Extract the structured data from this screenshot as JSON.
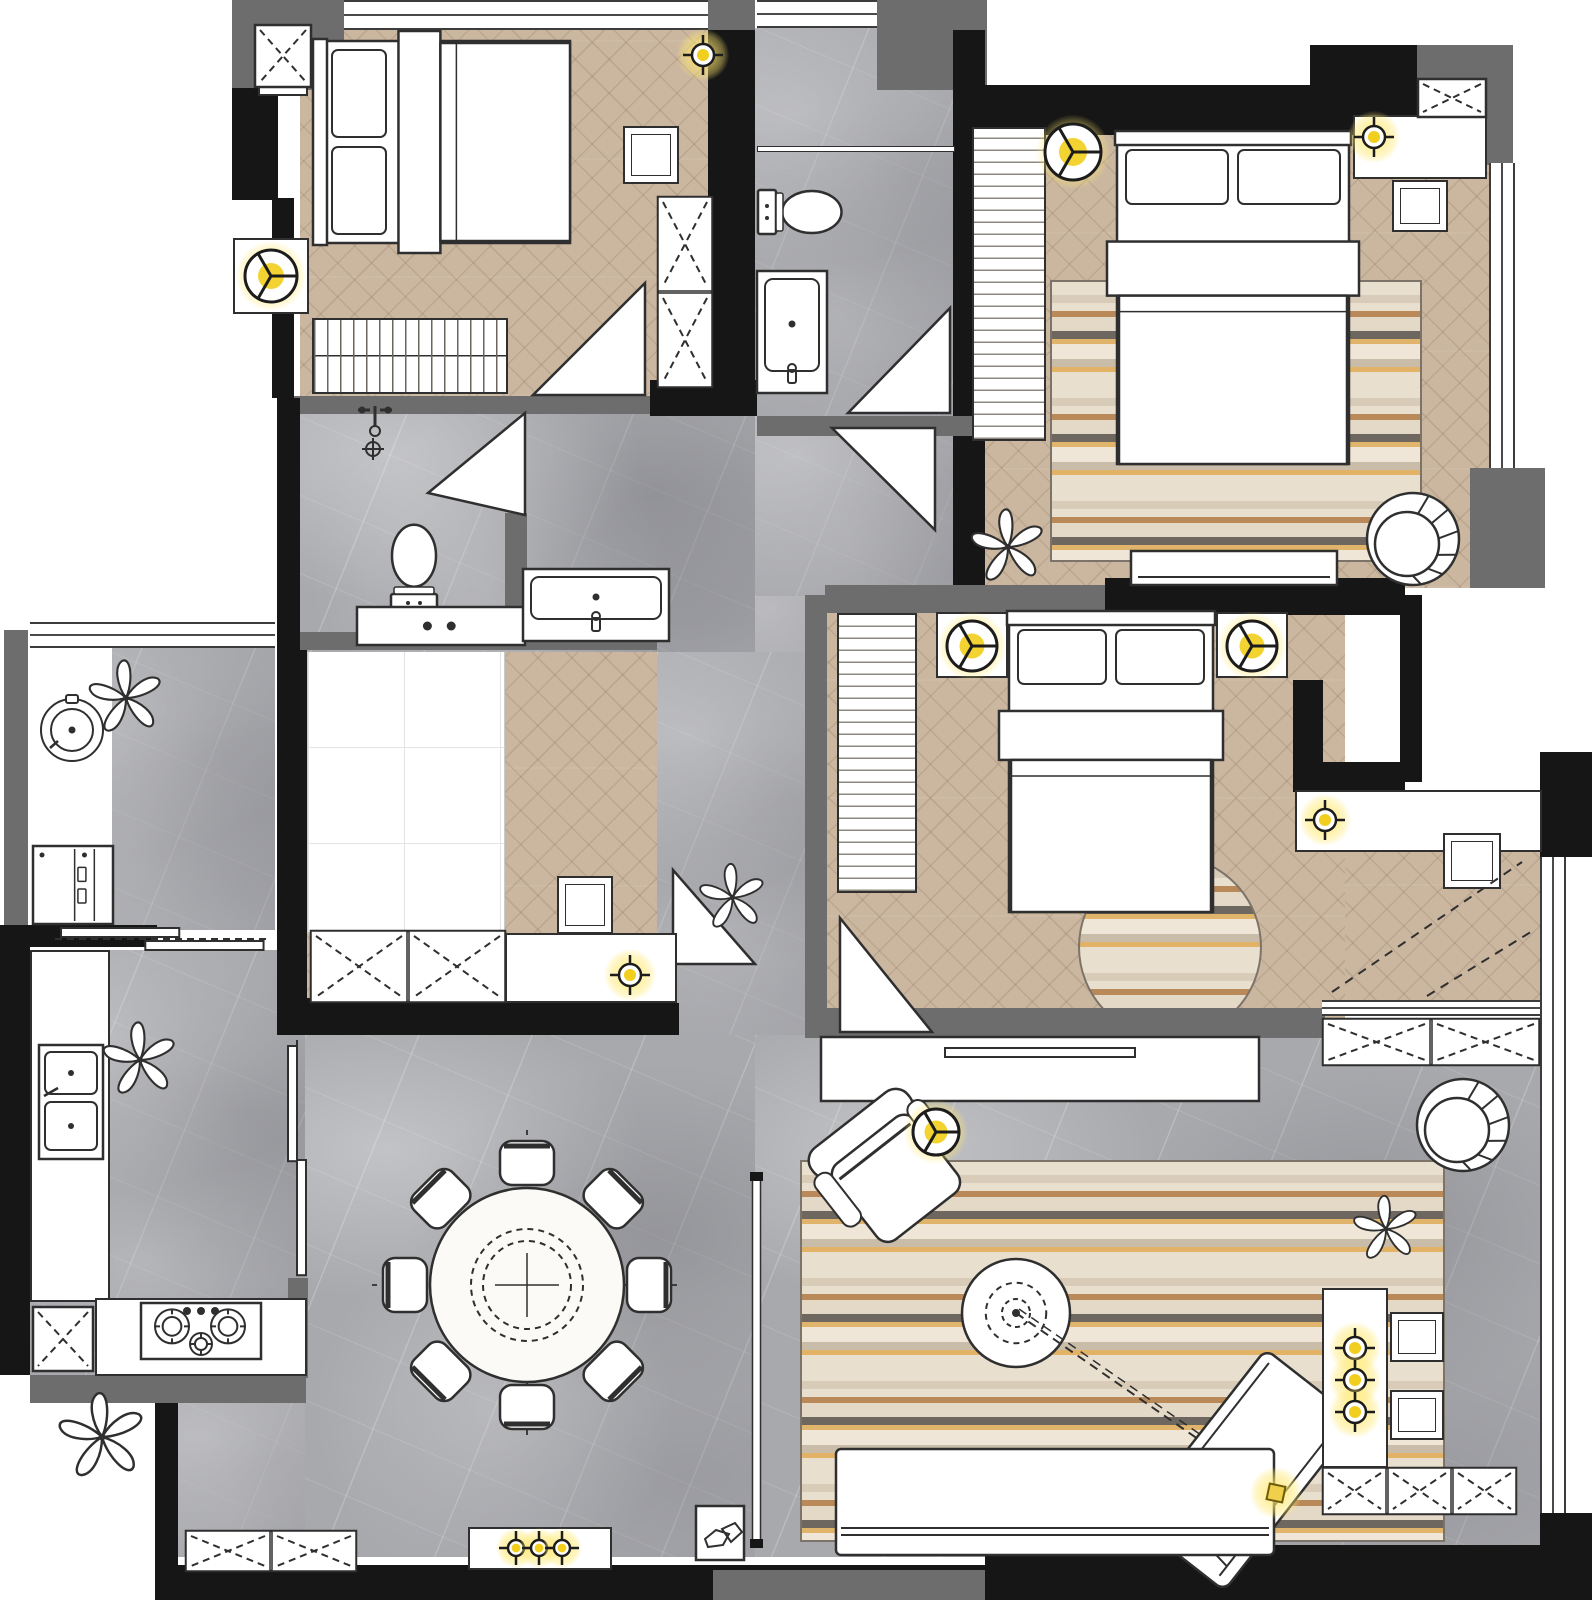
{
  "canvas": {
    "w": 1592,
    "h": 1600
  },
  "palette": {
    "wall_black": "#161616",
    "wall_gray": "#6d6d6d",
    "wood_floor": "#cbb7a0",
    "marble_floor": "#a8a9ad",
    "furniture_line": "#2f2f2f",
    "accent_yellow": "#f2cf1f",
    "rug_beige": "#e9dfce",
    "rug_brown": "#b9895a",
    "rug_dark": "#6e675f",
    "rug_orange": "#e0b46a"
  },
  "floors": [
    {
      "n": "bedroom-a-floor",
      "m": "wood",
      "x": 300,
      "y": 28,
      "w": 410,
      "h": 368
    },
    {
      "n": "bathroom-floor",
      "m": "marble",
      "x": 755,
      "y": 28,
      "w": 200,
      "h": 390
    },
    {
      "n": "master-bedroom-floor",
      "m": "wood",
      "x": 985,
      "y": 110,
      "w": 505,
      "h": 478
    },
    {
      "n": "bedroom-c-floor",
      "m": "wood",
      "x": 827,
      "y": 595,
      "w": 518,
      "h": 440
    },
    {
      "n": "bedroom-c-ext-floor",
      "m": "wood",
      "x": 1345,
      "y": 848,
      "w": 198,
      "h": 156
    },
    {
      "n": "tatami-room-floor",
      "m": "wood",
      "x": 307,
      "y": 650,
      "w": 350,
      "h": 355
    },
    {
      "n": "tatami-platform",
      "m": "platform",
      "x": 307,
      "y": 650,
      "w": 198,
      "h": 283
    },
    {
      "n": "hall-floor",
      "m": "marble",
      "x": 300,
      "y": 396,
      "w": 455,
      "h": 256
    },
    {
      "n": "hall-east-floor",
      "m": "marble",
      "x": 755,
      "y": 416,
      "w": 230,
      "h": 180
    },
    {
      "n": "hall-corner-floor",
      "m": "marble",
      "x": 755,
      "y": 596,
      "w": 72,
      "h": 58
    },
    {
      "n": "corridor-floor",
      "m": "marble",
      "x": 657,
      "y": 652,
      "w": 170,
      "h": 383
    },
    {
      "n": "balcony-floor",
      "m": "marble",
      "x": 28,
      "y": 648,
      "w": 247,
      "h": 282
    },
    {
      "n": "balcony-white-strip",
      "m": "white",
      "x": 28,
      "y": 648,
      "w": 84,
      "h": 282
    },
    {
      "n": "kitchen-floor",
      "m": "marble",
      "x": 30,
      "y": 950,
      "w": 276,
      "h": 428
    },
    {
      "n": "dining-floor",
      "m": "marble",
      "x": 305,
      "y": 1035,
      "w": 450,
      "h": 522
    },
    {
      "n": "dining-floor-sw",
      "m": "marble",
      "x": 178,
      "y": 1403,
      "w": 127,
      "h": 154
    },
    {
      "n": "living-floor",
      "m": "marble",
      "x": 755,
      "y": 1035,
      "w": 790,
      "h": 522
    }
  ],
  "rugs": [
    {
      "n": "master-bedroom-rug",
      "s": "rect",
      "x": 1050,
      "y": 280,
      "w": 372,
      "h": 282
    },
    {
      "n": "bedroom-c-round-rug",
      "s": "round",
      "x": 1078,
      "y": 855,
      "w": 184,
      "h": 184
    },
    {
      "n": "living-room-rug",
      "s": "rect",
      "x": 800,
      "y": 1160,
      "w": 645,
      "h": 382
    }
  ],
  "walls": [
    {
      "n": "wall-top-left-gray",
      "t": "g",
      "x": 232,
      "y": 0,
      "w": 112,
      "h": 90
    },
    {
      "n": "wall-left-upper",
      "t": "b",
      "x": 232,
      "y": 88,
      "w": 46,
      "h": 112
    },
    {
      "n": "wall-left-lower",
      "t": "b",
      "x": 272,
      "y": 198,
      "w": 22,
      "h": 200
    },
    {
      "n": "wall-bedroom-a-south",
      "t": "g",
      "x": 294,
      "y": 396,
      "w": 362,
      "h": 18
    },
    {
      "n": "wall-bath-sw",
      "t": "b",
      "x": 650,
      "y": 380,
      "w": 107,
      "h": 36
    },
    {
      "n": "wall-bedroom-a-east",
      "t": "b",
      "x": 708,
      "y": 28,
      "w": 47,
      "h": 362
    },
    {
      "n": "wall-bedroom-a-east-cap",
      "t": "g",
      "x": 708,
      "y": 0,
      "w": 47,
      "h": 30
    },
    {
      "n": "wall-bath-ne",
      "t": "g",
      "x": 877,
      "y": 0,
      "w": 110,
      "h": 90
    },
    {
      "n": "wall-bath-east",
      "t": "b",
      "x": 953,
      "y": 30,
      "w": 32,
      "h": 558
    },
    {
      "n": "wall-master-north",
      "t": "b",
      "x": 985,
      "y": 85,
      "w": 432,
      "h": 50
    },
    {
      "n": "wall-master-north-up",
      "t": "b",
      "x": 1310,
      "y": 45,
      "w": 107,
      "h": 42
    },
    {
      "n": "wall-ne-gray-h",
      "t": "g",
      "x": 1417,
      "y": 45,
      "w": 96,
      "h": 38
    },
    {
      "n": "wall-ne-gray-v",
      "t": "g",
      "x": 1487,
      "y": 50,
      "w": 26,
      "h": 115
    },
    {
      "n": "wall-east-gray-mid",
      "t": "g",
      "x": 1470,
      "y": 468,
      "w": 75,
      "h": 120
    },
    {
      "n": "wall-master-south-gray",
      "t": "g",
      "x": 825,
      "y": 585,
      "w": 282,
      "h": 28
    },
    {
      "n": "wall-master-south-black",
      "t": "b",
      "x": 1105,
      "y": 578,
      "w": 300,
      "h": 37
    },
    {
      "n": "wall-shaft-east",
      "t": "b",
      "x": 1400,
      "y": 595,
      "w": 22,
      "h": 187
    },
    {
      "n": "wall-nook-v",
      "t": "b",
      "x": 1293,
      "y": 680,
      "w": 30,
      "h": 112
    },
    {
      "n": "wall-nook-h",
      "t": "b",
      "x": 1293,
      "y": 762,
      "w": 112,
      "h": 28
    },
    {
      "n": "wall-entry-ne",
      "t": "b",
      "x": 1540,
      "y": 752,
      "w": 52,
      "h": 105
    },
    {
      "n": "wall-bedroom-c-west",
      "t": "g",
      "x": 805,
      "y": 595,
      "w": 22,
      "h": 440
    },
    {
      "n": "wall-bedroom-c-south",
      "t": "g",
      "x": 805,
      "y": 1008,
      "w": 520,
      "h": 30
    },
    {
      "n": "wall-hall-west",
      "t": "b",
      "x": 277,
      "y": 398,
      "w": 23,
      "h": 244
    },
    {
      "n": "wall-tatami-west",
      "t": "b",
      "x": 277,
      "y": 640,
      "w": 30,
      "h": 365
    },
    {
      "n": "wall-tatami-south",
      "t": "b",
      "x": 277,
      "y": 1003,
      "w": 402,
      "h": 32
    },
    {
      "n": "wall-powder-east",
      "t": "g",
      "x": 505,
      "y": 513,
      "w": 22,
      "h": 137
    },
    {
      "n": "wall-tatami-north",
      "t": "g",
      "x": 300,
      "y": 632,
      "w": 357,
      "h": 18
    },
    {
      "n": "wall-hall-gray-east",
      "t": "g",
      "x": 757,
      "y": 416,
      "w": 228,
      "h": 20
    },
    {
      "n": "wall-sink-alcove",
      "t": "g",
      "x": 512,
      "y": 566,
      "w": 12,
      "h": 78
    },
    {
      "n": "wall-balcony-west",
      "t": "g",
      "x": 4,
      "y": 630,
      "w": 24,
      "h": 298
    },
    {
      "n": "wall-balcony-kitchen",
      "t": "b",
      "x": 0,
      "y": 925,
      "w": 157,
      "h": 22
    },
    {
      "n": "wall-kitchen-west",
      "t": "b",
      "x": 0,
      "y": 947,
      "w": 30,
      "h": 428
    },
    {
      "n": "wall-kitchen-south-gray",
      "t": "g",
      "x": 30,
      "y": 1375,
      "w": 276,
      "h": 28
    },
    {
      "n": "wall-dining-west",
      "t": "b",
      "x": 155,
      "y": 1403,
      "w": 23,
      "h": 197
    },
    {
      "n": "wall-kitchen-ne",
      "t": "b",
      "x": 280,
      "y": 998,
      "w": 50,
      "h": 37
    },
    {
      "n": "wall-kitchen-east-low",
      "t": "g",
      "x": 288,
      "y": 1278,
      "w": 20,
      "h": 100
    },
    {
      "n": "wall-south-black",
      "t": "b",
      "x": 170,
      "y": 1565,
      "w": 845,
      "h": 35
    },
    {
      "n": "wall-south-gray",
      "t": "g",
      "x": 713,
      "y": 1570,
      "w": 275,
      "h": 30
    },
    {
      "n": "wall-south-east-black",
      "t": "b",
      "x": 985,
      "y": 1545,
      "w": 607,
      "h": 55
    },
    {
      "n": "wall-se-corner",
      "t": "b",
      "x": 1540,
      "y": 1513,
      "w": 52,
      "h": 87
    }
  ],
  "windows": [
    {
      "n": "window-bedroom-a",
      "o": "h",
      "x": 344,
      "y": 0,
      "w": 364,
      "h": 30
    },
    {
      "n": "window-bathroom",
      "o": "h",
      "x": 757,
      "y": 0,
      "w": 120,
      "h": 28
    },
    {
      "n": "window-balcony",
      "o": "h",
      "x": 30,
      "y": 622,
      "w": 245,
      "h": 26
    },
    {
      "n": "window-master-east",
      "o": "v",
      "x": 1489,
      "y": 163,
      "w": 26,
      "h": 305
    },
    {
      "n": "window-living-east",
      "o": "v",
      "x": 1540,
      "y": 857,
      "w": 26,
      "h": 656
    },
    {
      "n": "window-sill-entry",
      "o": "h",
      "x": 1322,
      "y": 1000,
      "w": 218,
      "h": 16
    }
  ],
  "doors": [
    {
      "n": "door-bedroom-a",
      "x": 533,
      "y": 283,
      "w": 112,
      "h": 112,
      "p": "0,112 112,112 112,0"
    },
    {
      "n": "door-powder-room",
      "x": 428,
      "y": 413,
      "w": 97,
      "h": 102,
      "p": "0,80 97,0 97,102"
    },
    {
      "n": "door-bathroom",
      "x": 848,
      "y": 308,
      "w": 102,
      "h": 105,
      "p": "102,0 102,105 0,105"
    },
    {
      "n": "door-master",
      "x": 832,
      "y": 428,
      "w": 103,
      "h": 102,
      "p": "0,0 103,0 103,102"
    },
    {
      "n": "door-bedroom-c",
      "x": 840,
      "y": 918,
      "w": 92,
      "h": 114,
      "p": "0,0 92,114 0,114"
    },
    {
      "n": "door-tatami",
      "x": 673,
      "y": 870,
      "w": 82,
      "h": 94,
      "p": "0,0 0,94 82,94"
    }
  ],
  "sliding_doors": [
    {
      "n": "sliding-door-balcony",
      "o": "h",
      "x": 55,
      "y": 926,
      "w": 215,
      "h": 26
    },
    {
      "n": "sliding-door-kitchen",
      "o": "v",
      "x": 286,
      "y": 1040,
      "w": 22,
      "h": 240
    }
  ],
  "furniture": [
    {
      "n": "bedroom-a-bed",
      "t": "bed-h",
      "x": 312,
      "y": 38,
      "w": 262,
      "h": 208
    },
    {
      "n": "bedroom-a-shelf",
      "t": "box",
      "x": 258,
      "y": 30,
      "w": 50,
      "h": 66
    },
    {
      "n": "bedroom-a-lamp-table",
      "t": "box",
      "x": 233,
      "y": 238,
      "w": 76,
      "h": 76
    },
    {
      "n": "bedroom-a-side-table",
      "t": "boxline",
      "x": 623,
      "y": 126,
      "w": 56,
      "h": 58
    },
    {
      "n": "bedroom-a-wardrobe",
      "t": "wx",
      "x": 657,
      "y": 196,
      "w": 56,
      "h": 192,
      "c": 2,
      "d": "col"
    },
    {
      "n": "bedroom-a-radiator",
      "t": "slatv",
      "x": 312,
      "y": 318,
      "w": 196,
      "h": 76
    },
    {
      "n": "duct-panel",
      "t": "wx",
      "x": 254,
      "y": 24,
      "w": 58,
      "h": 64,
      "c": 1,
      "d": "row"
    },
    {
      "n": "shower-glass",
      "t": "glass",
      "x": 757,
      "y": 146,
      "w": 198,
      "h": 6
    },
    {
      "n": "bathroom-toilet",
      "t": "toilet",
      "x": 756,
      "y": 184,
      "w": 90,
      "h": 56,
      "r": -90
    },
    {
      "n": "bathroom-vanity",
      "t": "vanity",
      "x": 756,
      "y": 270,
      "w": 72,
      "h": 124
    },
    {
      "n": "master-wardrobe",
      "t": "slath",
      "x": 972,
      "y": 127,
      "w": 74,
      "h": 314
    },
    {
      "n": "master-bed",
      "t": "bed-v",
      "x": 1114,
      "y": 130,
      "w": 238,
      "h": 338
    },
    {
      "n": "master-desk",
      "t": "box",
      "x": 1353,
      "y": 115,
      "w": 134,
      "h": 64
    },
    {
      "n": "master-corner-cabinet",
      "t": "wx",
      "x": 1417,
      "y": 78,
      "w": 70,
      "h": 40,
      "c": 1,
      "d": "row"
    },
    {
      "n": "master-stool",
      "t": "boxline",
      "x": 1392,
      "y": 180,
      "w": 56,
      "h": 52
    },
    {
      "n": "master-lowboard",
      "t": "lowboard",
      "x": 1130,
      "y": 550,
      "w": 208,
      "h": 36
    },
    {
      "n": "master-shell-chair",
      "t": "shell",
      "x": 1358,
      "y": 482,
      "w": 104,
      "h": 104
    },
    {
      "n": "master-plant",
      "t": "plant",
      "x": 963,
      "y": 505,
      "w": 90,
      "h": 84
    },
    {
      "n": "bedroom-c-wardrobe",
      "t": "slath",
      "x": 837,
      "y": 613,
      "w": 80,
      "h": 280
    },
    {
      "n": "bedroom-c-nightstand-left",
      "t": "box",
      "x": 936,
      "y": 612,
      "w": 72,
      "h": 66
    },
    {
      "n": "bedroom-c-nightstand-right",
      "t": "box",
      "x": 1216,
      "y": 612,
      "w": 72,
      "h": 66
    },
    {
      "n": "bedroom-c-bed",
      "t": "bed-v",
      "x": 1006,
      "y": 610,
      "w": 210,
      "h": 306
    },
    {
      "n": "bedroom-c-desk",
      "t": "box",
      "x": 1295,
      "y": 790,
      "w": 247,
      "h": 62
    },
    {
      "n": "bedroom-c-stool",
      "t": "boxline",
      "x": 1443,
      "y": 833,
      "w": 58,
      "h": 56
    },
    {
      "n": "tatami-stool",
      "t": "boxline",
      "x": 557,
      "y": 876,
      "w": 56,
      "h": 58
    },
    {
      "n": "tatami-wardrobe",
      "t": "wx",
      "x": 310,
      "y": 930,
      "w": 196,
      "h": 73,
      "c": 2,
      "d": "row"
    },
    {
      "n": "tatami-desk",
      "t": "box",
      "x": 505,
      "y": 933,
      "w": 172,
      "h": 70
    },
    {
      "n": "powder-toilet",
      "t": "toilet",
      "x": 385,
      "y": 520,
      "w": 58,
      "h": 94,
      "r": 180
    },
    {
      "n": "powder-counter",
      "t": "vanity2",
      "x": 356,
      "y": 606,
      "w": 170,
      "h": 40
    },
    {
      "n": "water-point-faucet",
      "t": "faucet",
      "x": 352,
      "y": 398,
      "w": 46,
      "h": 44
    },
    {
      "n": "floor-drain-mark",
      "t": "crossmark",
      "x": 360,
      "y": 436,
      "w": 26,
      "h": 26
    },
    {
      "n": "hall-wash-vanity",
      "t": "vanity",
      "x": 522,
      "y": 568,
      "w": 148,
      "h": 74
    },
    {
      "n": "hall-plant",
      "t": "plant",
      "x": 695,
      "y": 860,
      "w": 75,
      "h": 75
    },
    {
      "n": "balcony-washer",
      "t": "washer",
      "x": 36,
      "y": 694,
      "w": 72,
      "h": 72
    },
    {
      "n": "balcony-plant",
      "t": "plant",
      "x": 82,
      "y": 656,
      "w": 88,
      "h": 84
    },
    {
      "n": "balcony-cabinet",
      "t": "cab",
      "x": 32,
      "y": 845,
      "w": 82,
      "h": 80
    },
    {
      "n": "kitchen-counter-west",
      "t": "box",
      "x": 30,
      "y": 950,
      "w": 80,
      "h": 352
    },
    {
      "n": "kitchen-counter-south",
      "t": "box",
      "x": 95,
      "y": 1298,
      "w": 212,
      "h": 78
    },
    {
      "n": "kitchen-sink",
      "t": "ksink",
      "x": 38,
      "y": 1044,
      "w": 66,
      "h": 116
    },
    {
      "n": "kitchen-plant",
      "t": "plant",
      "x": 98,
      "y": 1018,
      "w": 84,
      "h": 84
    },
    {
      "n": "kitchen-cooktop",
      "t": "cooktop",
      "x": 140,
      "y": 1302,
      "w": 122,
      "h": 58
    },
    {
      "n": "kitchen-fridge",
      "t": "wx",
      "x": 32,
      "y": 1306,
      "w": 62,
      "h": 66,
      "c": 1,
      "d": "row"
    },
    {
      "n": "dining-table-set",
      "t": "dset",
      "x": 347,
      "y": 1105,
      "w": 360,
      "h": 360
    },
    {
      "n": "dining-sideboard",
      "t": "box",
      "x": 468,
      "y": 1527,
      "w": 144,
      "h": 43
    },
    {
      "n": "dining-shoe-cabinets",
      "t": "wx",
      "x": 185,
      "y": 1530,
      "w": 172,
      "h": 42,
      "c": 2,
      "d": "row"
    },
    {
      "n": "slipper-box",
      "t": "squig",
      "x": 695,
      "y": 1505,
      "w": 50,
      "h": 56
    },
    {
      "n": "column-divider",
      "t": "divider",
      "x": 750,
      "y": 1172,
      "w": 13,
      "h": 376
    },
    {
      "n": "tv-console",
      "t": "tvconsole",
      "x": 820,
      "y": 1036,
      "w": 440,
      "h": 66
    },
    {
      "n": "entry-door-swing",
      "t": "entryswing",
      "x": 1322,
      "y": 852,
      "w": 218,
      "h": 148
    },
    {
      "n": "entry-closets",
      "t": "wx",
      "x": 1322,
      "y": 1018,
      "w": 218,
      "h": 48,
      "c": 2,
      "d": "row"
    },
    {
      "n": "living-armchair",
      "t": "arm",
      "x": 812,
      "y": 1096,
      "w": 158,
      "h": 152
    },
    {
      "n": "coffee-table",
      "t": "ctable",
      "x": 954,
      "y": 1251,
      "w": 124,
      "h": 124
    },
    {
      "n": "projector-throw-line",
      "t": "projline",
      "x": 1016,
      "y": 1313,
      "w": 260,
      "h": 180
    },
    {
      "n": "chaise-lounge",
      "t": "chaise",
      "x": 1155,
      "y": 1352,
      "w": 180,
      "h": 235
    },
    {
      "n": "living-sofa",
      "t": "sofa",
      "x": 835,
      "y": 1448,
      "w": 440,
      "h": 108
    },
    {
      "n": "living-shell-chair",
      "t": "shell",
      "x": 1408,
      "y": 1068,
      "w": 110,
      "h": 110
    },
    {
      "n": "living-plant",
      "t": "plant",
      "x": 1338,
      "y": 1192,
      "w": 96,
      "h": 74
    },
    {
      "n": "bar-console",
      "t": "box",
      "x": 1322,
      "y": 1288,
      "w": 66,
      "h": 180
    },
    {
      "n": "bar-stool-1",
      "t": "boxline",
      "x": 1390,
      "y": 1312,
      "w": 54,
      "h": 50
    },
    {
      "n": "bar-stool-2",
      "t": "boxline",
      "x": 1390,
      "y": 1390,
      "w": 54,
      "h": 50
    },
    {
      "n": "living-storage-cabinets",
      "t": "wx",
      "x": 1322,
      "y": 1467,
      "w": 195,
      "h": 48,
      "c": 3,
      "d": "row"
    },
    {
      "n": "outdoor-plant",
      "t": "plant",
      "x": 52,
      "y": 1388,
      "w": 100,
      "h": 98
    }
  ],
  "lights": [
    {
      "n": "ceiling-light",
      "k": "cross",
      "x": 703,
      "y": 55
    },
    {
      "n": "ceiling-light",
      "k": "tri",
      "x": 271,
      "y": 276,
      "s": 26
    },
    {
      "n": "ceiling-light",
      "k": "tri",
      "x": 1073,
      "y": 152,
      "s": 28
    },
    {
      "n": "ceiling-light",
      "k": "cross",
      "x": 1374,
      "y": 137
    },
    {
      "n": "ceiling-light",
      "k": "tri",
      "x": 972,
      "y": 646,
      "s": 25
    },
    {
      "n": "ceiling-light",
      "k": "tri",
      "x": 1252,
      "y": 646,
      "s": 25
    },
    {
      "n": "ceiling-light",
      "k": "cross",
      "x": 1325,
      "y": 820
    },
    {
      "n": "ceiling-light",
      "k": "cross",
      "x": 630,
      "y": 975
    },
    {
      "n": "ceiling-light",
      "k": "tri",
      "x": 936,
      "y": 1132,
      "s": 23
    },
    {
      "n": "ceiling-light",
      "k": "cross",
      "x": 1355,
      "y": 1348
    },
    {
      "n": "ceiling-light",
      "k": "cross",
      "x": 1355,
      "y": 1380
    },
    {
      "n": "ceiling-light",
      "k": "cross",
      "x": 1355,
      "y": 1412
    },
    {
      "n": "floor-light",
      "k": "sq",
      "x": 1276,
      "y": 1493
    },
    {
      "n": "cabinet-light",
      "k": "cross-s",
      "x": 516,
      "y": 1548
    },
    {
      "n": "cabinet-light",
      "k": "cross-s",
      "x": 539,
      "y": 1548
    },
    {
      "n": "cabinet-light",
      "k": "cross-s",
      "x": 562,
      "y": 1548
    }
  ]
}
